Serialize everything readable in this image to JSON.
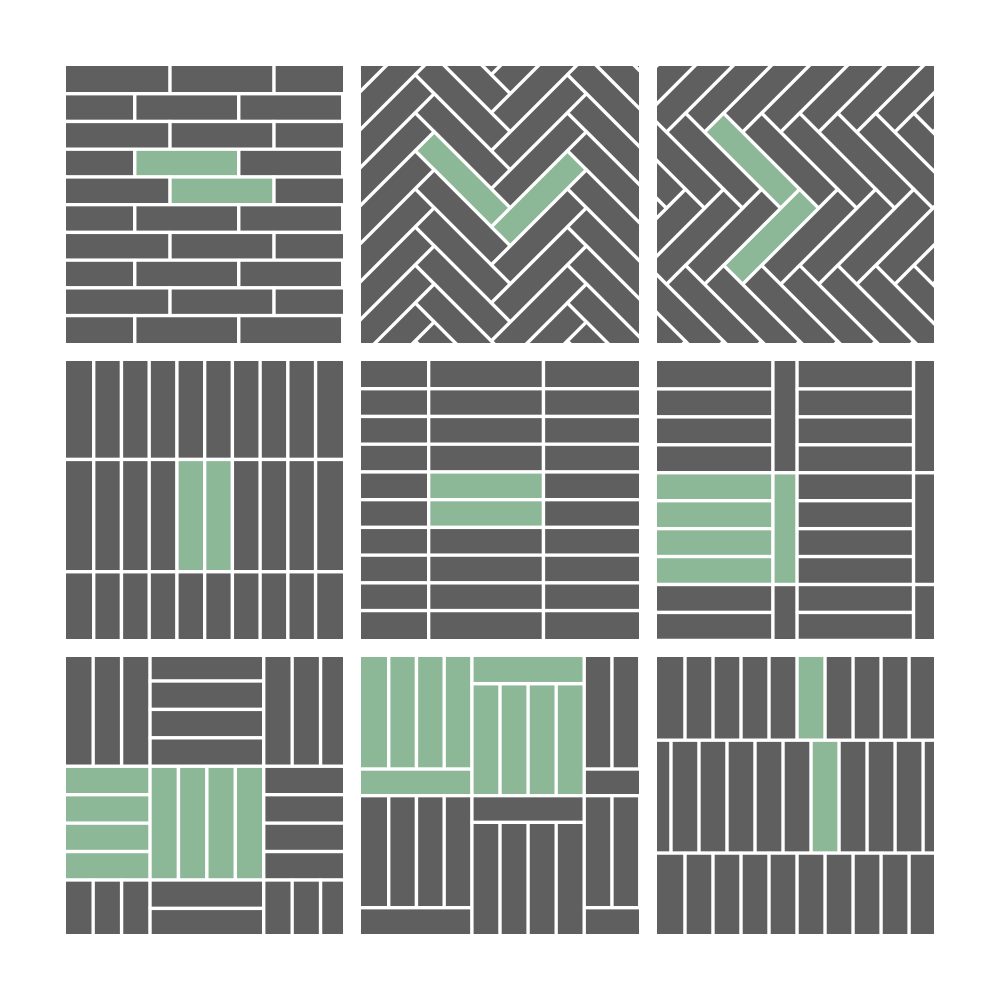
{
  "title": "Tile laying pattern swatches",
  "palette": {
    "brick": "#5f5f5f",
    "highlight": "#8cb897",
    "grout": "#ffffff",
    "background": "#ffffff"
  },
  "grout_width": 1.2,
  "board": {
    "rows": 3,
    "cols": 3,
    "size_px": 1000,
    "padding_px": 66,
    "gap_px": 18
  },
  "tiles": [
    {
      "id": "running-bond-horizontal",
      "gen": "bond_h",
      "params": {
        "rows": 10,
        "brick_w": 37.5,
        "phases": [
          37.5,
          24.8
        ]
      },
      "green_points": [
        [
          43,
          35
        ],
        [
          56,
          45
        ]
      ]
    },
    {
      "id": "herringbone-chevron-down",
      "gen": "herringbone",
      "params": {
        "k": 4,
        "bw": 9.7,
        "rot": -45,
        "ox": 47,
        "oy": 58
      },
      "green_points": [
        [
          36.7,
          40.9
        ],
        [
          64.1,
          47.7
        ]
      ]
    },
    {
      "id": "herringbone-chevron-right",
      "gen": "herringbone",
      "params": {
        "k": 4,
        "bw": 9.7,
        "rot": 45,
        "ox": 24,
        "oy": 17
      },
      "green_points": [
        [
          34.3,
          34.1
        ],
        [
          41.1,
          61.6
        ]
      ]
    },
    {
      "id": "stack-bond-vertical",
      "gen": "grid",
      "params": {
        "row_edges": [
          0,
          35.5,
          76,
          100
        ],
        "col_edges": [
          0,
          10,
          20,
          30,
          40,
          50,
          60,
          70,
          80,
          90,
          100
        ]
      },
      "green_points": [
        [
          45,
          56
        ],
        [
          55,
          56
        ]
      ]
    },
    {
      "id": "stack-bond-horizontal",
      "gen": "grid",
      "params": {
        "row_edges": [
          0,
          10,
          20,
          30,
          40,
          50,
          60,
          70,
          80,
          90,
          100
        ],
        "col_edges": [
          0,
          24.4,
          65.8,
          100
        ]
      },
      "green_points": [
        [
          45,
          45
        ],
        [
          45,
          55
        ]
      ]
    },
    {
      "id": "ladder-blocks",
      "gen": "ladder",
      "params": {
        "bands": 3,
        "band_h": 40.3,
        "planks": 4,
        "cols": [
          {
            "h": [
              0,
              41.8
            ],
            "v": [
              41.8,
              50.5
            ]
          },
          {
            "h": [
              50.5,
              92.5
            ],
            "v": [
              92.5,
              100
            ]
          }
        ]
      },
      "green_points": [
        [
          20.9,
          45.3
        ],
        [
          20.9,
          55.4
        ],
        [
          20.9,
          65.5
        ],
        [
          20.9,
          75.6
        ],
        [
          46.2,
          60.5
        ]
      ]
    },
    {
      "id": "basketweave",
      "gen": "basket",
      "params": {
        "block": 41,
        "planks": 4,
        "ox": -10.7,
        "oy": -1.6,
        "cols": 4,
        "rows": 3
      },
      "green_points": [
        [
          9.8,
          44.5
        ],
        [
          9.8,
          54.8
        ],
        [
          9.8,
          65
        ],
        [
          9.8,
          75.3
        ],
        [
          35.4,
          59.9
        ],
        [
          45.7,
          59.9
        ],
        [
          55.9,
          59.9
        ],
        [
          66.2,
          59.9
        ]
      ]
    },
    {
      "id": "vertical-blocks-capped",
      "gen": "blockcap",
      "params": {
        "bands": 2,
        "unit_h": 50,
        "cap_h": 9.6,
        "planks": 4,
        "cols": [
          {
            "x": [
              0,
              40
            ],
            "cap": "bottom"
          },
          {
            "x": [
              40,
              80.5
            ],
            "cap": "top"
          },
          {
            "x": [
              80.5,
              120.5
            ],
            "cap": "bottom"
          }
        ]
      },
      "green_points": [
        [
          5,
          20
        ],
        [
          15,
          20
        ],
        [
          25,
          20
        ],
        [
          35,
          20
        ],
        [
          20,
          45.2
        ],
        [
          60.2,
          4.8
        ],
        [
          45.1,
          29.8
        ],
        [
          55.2,
          29.8
        ],
        [
          65.3,
          29.8
        ],
        [
          75.4,
          29.8
        ]
      ]
    },
    {
      "id": "running-bond-vertical",
      "gen": "bond_v",
      "params": {
        "col_w": 10.1,
        "row_edges": [
          0,
          30,
          70.7,
          100
        ],
        "phases": [
          0,
          -5.05,
          0
        ]
      },
      "green_points": [
        [
          55.5,
          15
        ],
        [
          60.6,
          50.3
        ]
      ]
    }
  ]
}
